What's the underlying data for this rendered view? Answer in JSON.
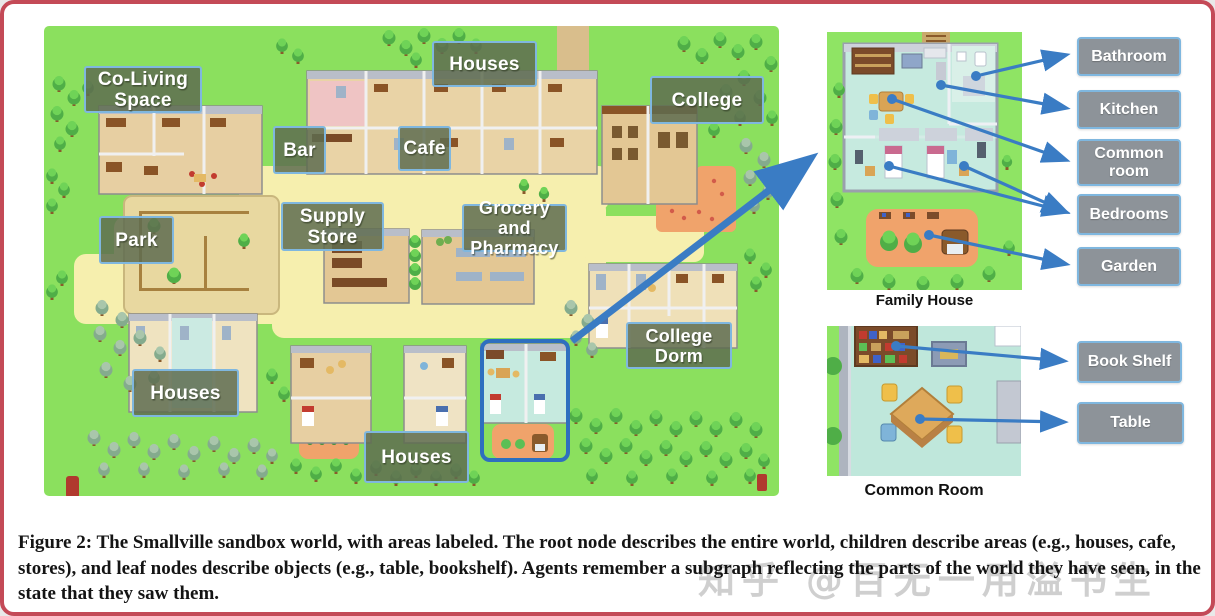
{
  "figure": {
    "caption": "Figure 2: The Smallville sandbox world, with areas labeled. The root node describes the entire world, children describe areas (e.g., houses, cafe, stores), and leaf nodes describe objects (e.g., table, bookshelf). Agents remember a subgraph reflecting the parts of the world they have seen, in the state that they saw them."
  },
  "watermark": {
    "text": "知乎 @百无一用溢书生"
  },
  "map": {
    "labels": [
      {
        "id": "co-living-space",
        "text": "Co-Living Space"
      },
      {
        "id": "houses-top",
        "text": "Houses"
      },
      {
        "id": "bar",
        "text": "Bar"
      },
      {
        "id": "cafe",
        "text": "Cafe"
      },
      {
        "id": "college",
        "text": "College"
      },
      {
        "id": "supply-store",
        "text": "Supply Store"
      },
      {
        "id": "grocery-and-pharmacy",
        "text": "Grocery and Pharmacy"
      },
      {
        "id": "park",
        "text": "Park"
      },
      {
        "id": "houses-bottom-left",
        "text": "Houses"
      },
      {
        "id": "college-dorm",
        "text": "College Dorm"
      },
      {
        "id": "houses-bottom-middle",
        "text": "Houses"
      }
    ]
  },
  "panels": {
    "family_house": {
      "title": "Family House",
      "labels": [
        "Bathroom",
        "Kitchen",
        "Common room",
        "Bedrooms",
        "Garden"
      ]
    },
    "common_room": {
      "title": "Common Room",
      "labels": [
        "Book Shelf",
        "Table"
      ]
    }
  },
  "colors": {
    "figure_border": "#c44a57",
    "arrow_blue": "#3a7cc4",
    "map_label_bg": "#5e6c50",
    "map_label_border": "#7fb7df",
    "annotation_label_bg": "#8d9399",
    "grass_green": "#8be05e",
    "path_yellow": "#f6efae",
    "garden_orange": "#f0a36b"
  }
}
